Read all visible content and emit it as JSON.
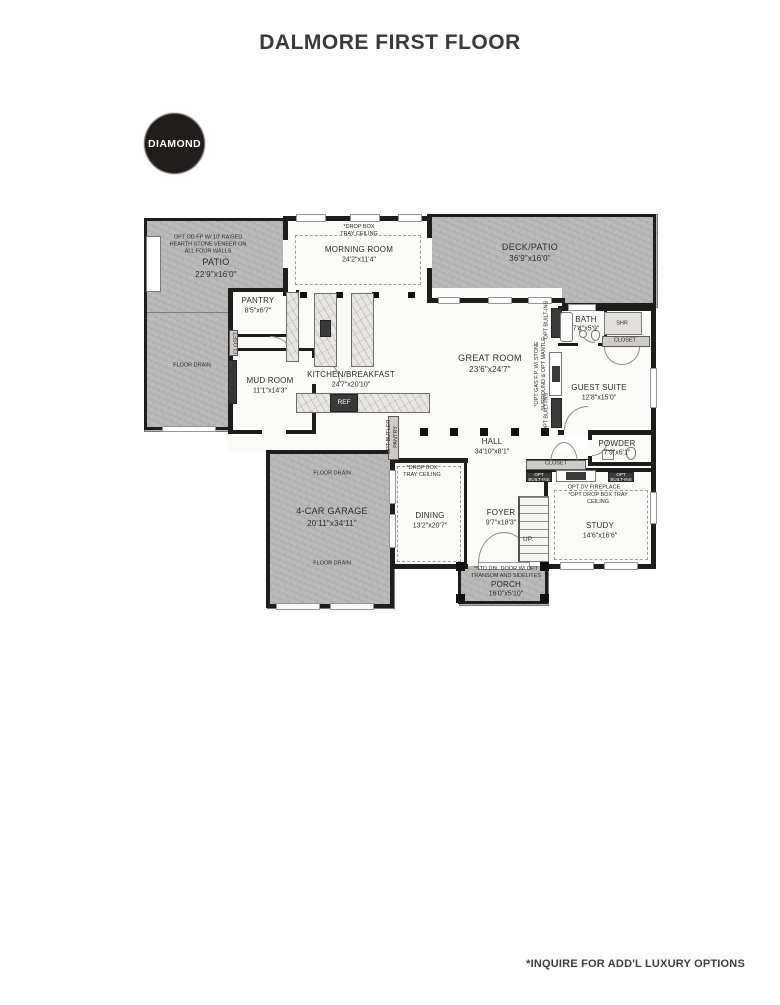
{
  "title": "DALMORE FIRST FLOOR",
  "badge": "DIAMOND",
  "footnote": "*INQUIRE FOR ADD'L LUXURY OPTIONS",
  "rooms": {
    "patio": {
      "name": "PATIO",
      "dims": "22'9\"x16'0\"",
      "note": "OPT OD FP W/ 10' RAISED\nHEARTH STONE VENEER ON\nALL FOUR WALLS"
    },
    "morning": {
      "name": "MORNING ROOM",
      "dims": "24'2\"x11'4\"",
      "note": "*DROP BOX\nTRAY CEILING"
    },
    "deck": {
      "name": "DECK/PATIO",
      "dims": "36'9\"x16'0\""
    },
    "pantry": {
      "name": "PANTRY",
      "dims": "8'5\"x6'7\""
    },
    "mud": {
      "name": "MUD ROOM",
      "dims": "11'1\"x14'3\""
    },
    "kitchen": {
      "name": "KITCHEN/BREAKFAST",
      "dims": "24'7\"x20'10\""
    },
    "great": {
      "name": "GREAT ROOM",
      "dims": "23'6\"x24'7\""
    },
    "bath": {
      "name": "BATH",
      "dims": "7'4\"x5'9\""
    },
    "guest": {
      "name": "GUEST SUITE",
      "dims": "12'8\"x15'0\""
    },
    "hall": {
      "name": "HALL",
      "dims": "34'10\"x8'1\""
    },
    "powder": {
      "name": "POWDER",
      "dims": "7'9\"x6'1\""
    },
    "dining": {
      "name": "DINING",
      "dims": "13'2\"x20'7\"",
      "note": "*DROP BOX\nTRAY CEILING"
    },
    "foyer": {
      "name": "FOYER",
      "dims": "9'7\"x18'3\""
    },
    "study": {
      "name": "STUDY",
      "dims": "14'6\"x16'6\"",
      "note_fireplace": "OPT DV FIREPLACE",
      "note_tray": "*OPT DROP BOX TRAY\nCEILING"
    },
    "garage": {
      "name": "4-CAR GARAGE",
      "dims": "20'11\"x34'11\""
    },
    "porch": {
      "name": "PORCH",
      "dims": "16'0\"x5'10\"",
      "note": "*STD DBL DOOR W/ OPT\nTRANSOM AND SIDELITES"
    }
  },
  "labels": {
    "shr": "SHR",
    "closet": "CLOSET",
    "ref": "REF",
    "up": "UP.",
    "floor_drain": "FLOOR DRAIN",
    "opt_builtins": "OPT BUILT-INS",
    "opt_builtins_2l": "OPT\nBUILT-INS",
    "opt_gas_fp": "*OPT GAS F.P. W/ STONE\nSURROUND & OPT MANTLE",
    "opt_butler": "OPT BUTLER\nPANTRY"
  }
}
